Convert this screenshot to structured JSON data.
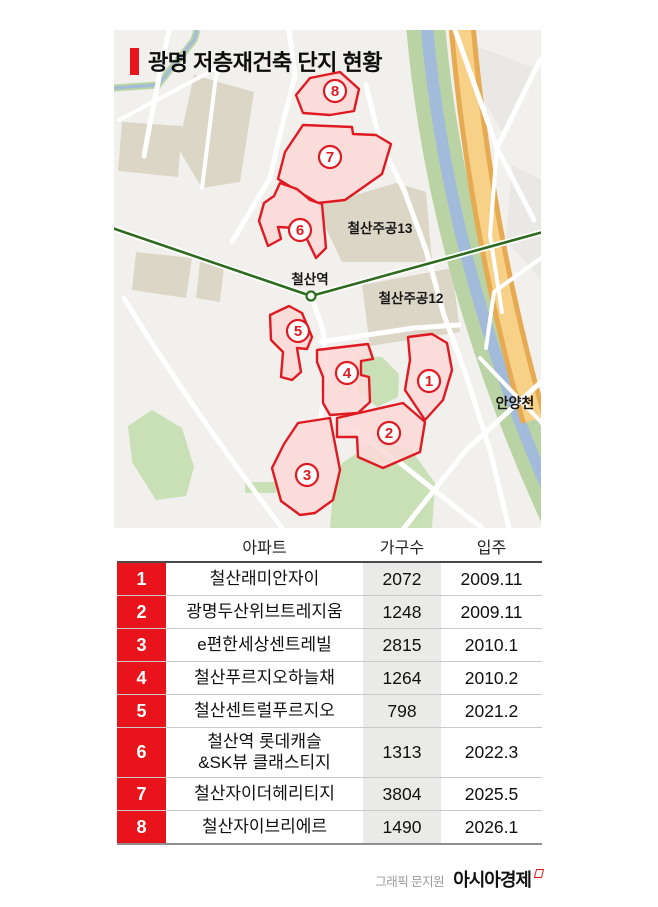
{
  "title": {
    "text": "광명 저층재건축 단지 현황"
  },
  "map": {
    "station_label": "철산역",
    "area13_label": "철산주공13",
    "area12_label": "철산주공12",
    "river_label": "안양천",
    "zones": [
      {
        "no": "1"
      },
      {
        "no": "2"
      },
      {
        "no": "3"
      },
      {
        "no": "4"
      },
      {
        "no": "5"
      },
      {
        "no": "6"
      },
      {
        "no": "7"
      },
      {
        "no": "8"
      }
    ]
  },
  "table": {
    "headers": [
      "아파트",
      "가구수",
      "입주"
    ],
    "rows": [
      {
        "no": "1",
        "name": "철산래미안자이",
        "households": "2072",
        "movein": "2009.11"
      },
      {
        "no": "2",
        "name": "광명두산위브트레지움",
        "households": "1248",
        "movein": "2009.11"
      },
      {
        "no": "3",
        "name": "e편한세상센트레빌",
        "households": "2815",
        "movein": "2010.1"
      },
      {
        "no": "4",
        "name": "철산푸르지오하늘채",
        "households": "1264",
        "movein": "2010.2"
      },
      {
        "no": "5",
        "name": "철산센트럴푸르지오",
        "households": "798",
        "movein": "2021.2"
      },
      {
        "no": "6",
        "name": "철산역 롯데캐슬\n&SK뷰 클래스티지",
        "households": "1313",
        "movein": "2022.3"
      },
      {
        "no": "7",
        "name": "철산자이더헤리티지",
        "households": "3804",
        "movein": "2025.5"
      },
      {
        "no": "8",
        "name": "철산자이브리에르",
        "households": "1490",
        "movein": "2026.1"
      }
    ]
  },
  "footer": {
    "credit": "그래픽 문지원",
    "brand": "아시아경제"
  },
  "colors": {
    "accent_red": "#e8131b",
    "zone_border": "#e01a22",
    "zone_fill": "#fadad8",
    "households_col_bg": "#eaeae8",
    "map_bg": "#f1f0ed",
    "block_tan": "#dcd6c6",
    "park_green": "#c9e0b6",
    "river_blue": "#a3bbdb",
    "river_bank_green": "#b9d3a4",
    "riverside_road_orange": "#e6aa52",
    "subway_green": "#2f6b1f"
  }
}
